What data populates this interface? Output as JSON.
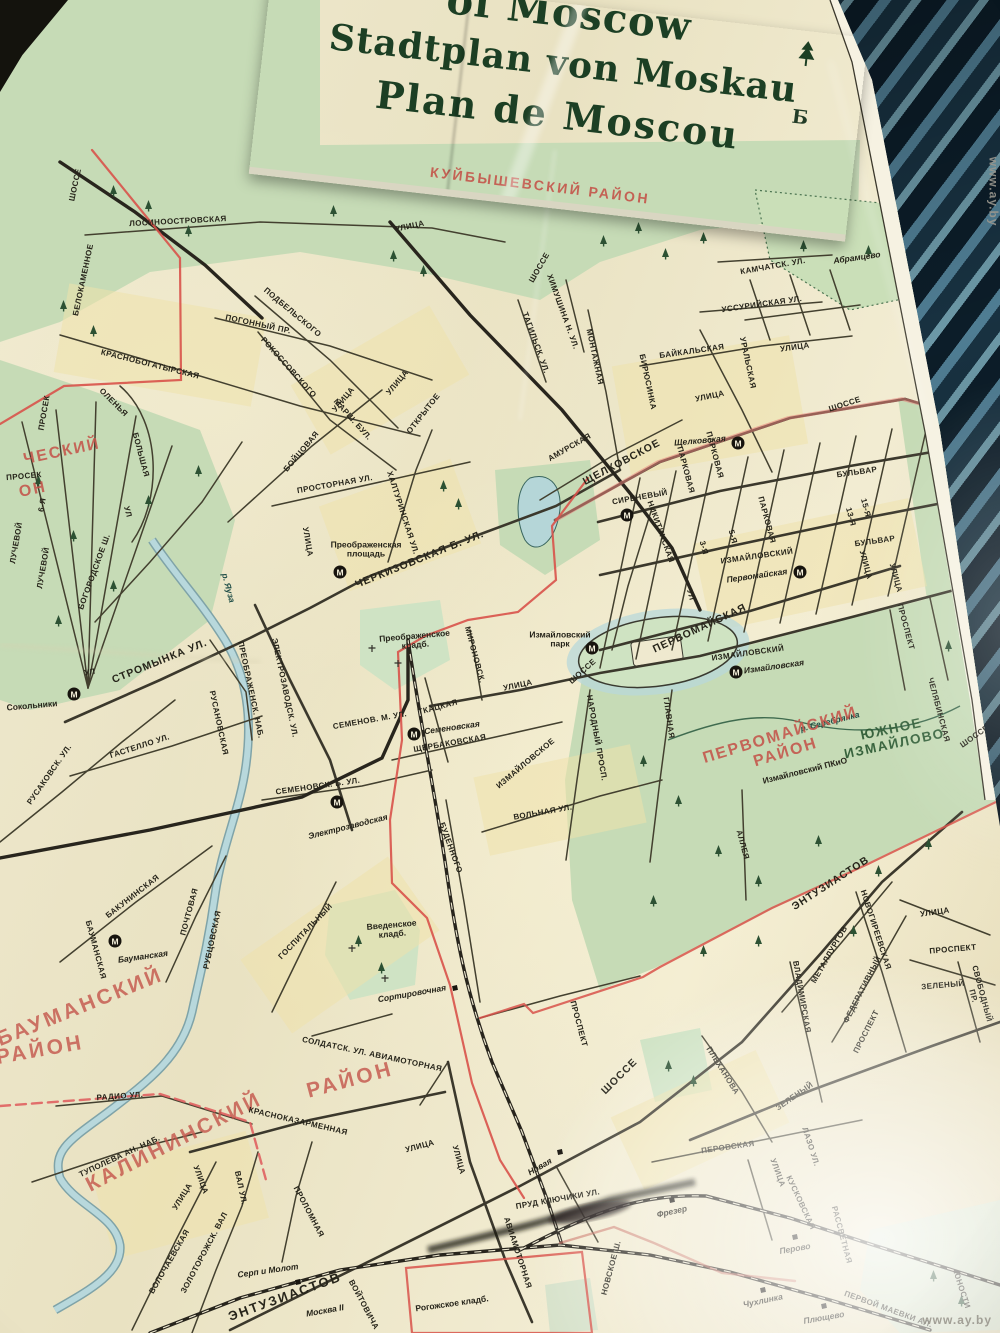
{
  "header": {
    "title_line1": "of Moscow",
    "title_line2": "Stadtplan von Moskau",
    "title_line3": "Plan de Moscou"
  },
  "photo": {
    "watermark": "www.ay.by"
  },
  "colors": {
    "paper": "#ece6c9",
    "park": "#c6dbb6",
    "water": "#aed2d8",
    "road_ink": "#3b382c",
    "rail_ink": "#28251d",
    "boundary_red": "#d8524a",
    "district_red": "#c4544a",
    "cover_green": "#8cad8a",
    "title_ink": "#1c3f24"
  },
  "metro_symbol": "М",
  "metro": [
    {
      "x": 74,
      "y": 694
    },
    {
      "x": 340,
      "y": 572
    },
    {
      "x": 627,
      "y": 515
    },
    {
      "x": 738,
      "y": 443
    },
    {
      "x": 800,
      "y": 572
    },
    {
      "x": 592,
      "y": 648
    },
    {
      "x": 736,
      "y": 672
    },
    {
      "x": 414,
      "y": 734
    },
    {
      "x": 337,
      "y": 802
    },
    {
      "x": 115,
      "y": 941
    }
  ],
  "rail_markers": [
    {
      "x": 455,
      "y": 988
    },
    {
      "x": 298,
      "y": 1282
    },
    {
      "x": 560,
      "y": 1152
    },
    {
      "x": 672,
      "y": 1200
    },
    {
      "x": 795,
      "y": 1237
    },
    {
      "x": 763,
      "y": 1290
    },
    {
      "x": 824,
      "y": 1306
    }
  ],
  "map_labels": [
    {
      "t": "КУЙБЫШЕВСКИЙ  РАЙОН",
      "x": 540,
      "y": 186,
      "r": 7,
      "c": 5
    },
    {
      "t": "ЛОСИНООСТРОВСКАЯ",
      "x": 178,
      "y": 222,
      "r": -3,
      "c": 0
    },
    {
      "t": "УЛИЦА",
      "x": 410,
      "y": 227,
      "r": -12,
      "c": 0
    },
    {
      "t": "ШОССЕ",
      "x": 540,
      "y": 268,
      "r": -60,
      "c": 0
    },
    {
      "t": "ШОССЕ",
      "x": 76,
      "y": 185,
      "r": -78,
      "c": 0
    },
    {
      "t": "БЕЛОКАМЕННОЕ",
      "x": 84,
      "y": 280,
      "r": -78,
      "c": 0
    },
    {
      "t": "ПОГОННЫЙ  ПР.",
      "x": 258,
      "y": 325,
      "r": 12,
      "c": 0
    },
    {
      "t": "ПОДБЕЛЬСКОГО",
      "x": 292,
      "y": 313,
      "r": 40,
      "c": 0
    },
    {
      "t": "РОКОССОВСКОГО",
      "x": 288,
      "y": 368,
      "r": 48,
      "c": 0
    },
    {
      "t": "МАРШ. БУЛ.",
      "x": 352,
      "y": 420,
      "r": 48,
      "c": 0
    },
    {
      "t": "БОЙЦОВАЯ",
      "x": 302,
      "y": 452,
      "r": -50,
      "c": 0
    },
    {
      "t": "УЛИЦА",
      "x": 344,
      "y": 400,
      "r": -50,
      "c": 0
    },
    {
      "t": "УЛИЦА",
      "x": 398,
      "y": 383,
      "r": -50,
      "c": 0
    },
    {
      "t": "ОТКРЫТОЕ",
      "x": 424,
      "y": 414,
      "r": -52,
      "c": 0
    },
    {
      "t": "КРАСНОБОГАТЫРСКАЯ",
      "x": 150,
      "y": 365,
      "r": 14,
      "c": 0
    },
    {
      "t": "ТАГИЛЬСК. УЛ.",
      "x": 535,
      "y": 343,
      "r": 70,
      "c": 0
    },
    {
      "t": "ХИМУШИНА Н. УЛ.",
      "x": 562,
      "y": 312,
      "r": 70,
      "c": 0
    },
    {
      "t": "МОНТАЖНАЯ",
      "x": 594,
      "y": 357,
      "r": 78,
      "c": 0
    },
    {
      "t": "БИРЮСИНКА",
      "x": 647,
      "y": 382,
      "r": 78,
      "c": 0
    },
    {
      "t": "КАМЧАТСК. УЛ.",
      "x": 773,
      "y": 267,
      "r": -10,
      "c": 0
    },
    {
      "t": "УССУРИЙСКАЯ УЛ.",
      "x": 762,
      "y": 305,
      "r": -8,
      "c": 0
    },
    {
      "t": "Абрамцево",
      "x": 857,
      "y": 258,
      "r": -8,
      "c": 3
    },
    {
      "t": "БАЙКАЛЬСКАЯ",
      "x": 692,
      "y": 352,
      "r": -8,
      "c": 0
    },
    {
      "t": "УРАЛЬСКАЯ",
      "x": 747,
      "y": 363,
      "r": 78,
      "c": 0
    },
    {
      "t": "УЛИЦА",
      "x": 795,
      "y": 348,
      "r": -8,
      "c": 0
    },
    {
      "t": "УЛИЦА",
      "x": 710,
      "y": 397,
      "r": -12,
      "c": 0
    },
    {
      "t": "ШОССЕ",
      "x": 845,
      "y": 405,
      "r": -18,
      "c": 0
    },
    {
      "t": "АМУРСКАЯ",
      "x": 570,
      "y": 448,
      "r": -30,
      "c": 0
    },
    {
      "t": "ЩЕЛКОВСКОЕ",
      "x": 622,
      "y": 463,
      "r": -28,
      "c": 1
    },
    {
      "t": "Щелковская",
      "x": 700,
      "y": 441,
      "r": -5,
      "c": 3
    },
    {
      "t": "СИРЕНЕВЫЙ",
      "x": 640,
      "y": 498,
      "r": -10,
      "c": 0
    },
    {
      "t": "НИКИТИНСКАЯ",
      "x": 660,
      "y": 532,
      "r": 70,
      "c": 0
    },
    {
      "t": "ПАРКОВАЯ",
      "x": 685,
      "y": 470,
      "r": 75,
      "c": 0
    },
    {
      "t": "ПАРКОВАЯ",
      "x": 714,
      "y": 455,
      "r": 75,
      "c": 0
    },
    {
      "t": "ПАРКОВАЯ",
      "x": 766,
      "y": 520,
      "r": 75,
      "c": 0
    },
    {
      "t": "БУЛЬВАР",
      "x": 857,
      "y": 473,
      "r": -8,
      "c": 0
    },
    {
      "t": "ИЗМАЙЛОВСКИЙ",
      "x": 757,
      "y": 557,
      "r": -8,
      "c": 0
    },
    {
      "t": "БУЛЬВАР",
      "x": 875,
      "y": 542,
      "r": -8,
      "c": 0
    },
    {
      "t": "3-Я",
      "x": 703,
      "y": 548,
      "r": 75,
      "c": 0
    },
    {
      "t": "5-Я",
      "x": 732,
      "y": 537,
      "r": 75,
      "c": 0
    },
    {
      "t": "13-Я",
      "x": 850,
      "y": 517,
      "r": 75,
      "c": 0
    },
    {
      "t": "15-Я",
      "x": 865,
      "y": 508,
      "r": 75,
      "c": 0
    },
    {
      "t": "УЛ",
      "x": 690,
      "y": 595,
      "r": 75,
      "c": 0
    },
    {
      "t": "УЛИЦА",
      "x": 865,
      "y": 565,
      "r": 75,
      "c": 0
    },
    {
      "t": "УЛИЦА",
      "x": 895,
      "y": 578,
      "r": 75,
      "c": 0
    },
    {
      "t": "Первомайская",
      "x": 757,
      "y": 576,
      "r": -8,
      "c": 3
    },
    {
      "t": "ПЕРВОМАЙСКАЯ",
      "x": 700,
      "y": 629,
      "r": -25,
      "c": 1
    },
    {
      "t": "ИЗМАЙЛОВСКИЙ",
      "x": 748,
      "y": 654,
      "r": -8,
      "c": 0
    },
    {
      "t": "ПРОСПЕКТ",
      "x": 905,
      "y": 627,
      "r": 75,
      "c": 0
    },
    {
      "t": "Измайловская",
      "x": 774,
      "y": 667,
      "r": -8,
      "c": 3
    },
    {
      "t": "МОСКОВСКАЯ",
      "x": 965,
      "y": 557,
      "r": 82,
      "c": 0
    },
    {
      "t": "В",
      "x": 962,
      "y": 503,
      "r": 0,
      "c": 8
    },
    {
      "t": "Б",
      "x": 800,
      "y": 118,
      "r": 7,
      "c": 8
    },
    {
      "t": "ЧЕРКИЗОВСКАЯ  Б.  УЛ.",
      "x": 420,
      "y": 560,
      "r": -22,
      "c": 1
    },
    {
      "t": "Преображенская\nплощадь",
      "x": 366,
      "y": 550,
      "r": 0,
      "c": 4
    },
    {
      "t": "ПРОСТОРНАЯ УЛ.",
      "x": 335,
      "y": 485,
      "r": -10,
      "c": 0
    },
    {
      "t": "ХАЛТУРИНСКАЯ УЛ.",
      "x": 402,
      "y": 513,
      "r": 72,
      "c": 0
    },
    {
      "t": "УЛИЦА",
      "x": 307,
      "y": 542,
      "r": 80,
      "c": 0
    },
    {
      "t": "Преображенское\nкладб.",
      "x": 415,
      "y": 641,
      "r": -5,
      "c": 4
    },
    {
      "t": "МИРОНОВСК.",
      "x": 474,
      "y": 655,
      "r": 75,
      "c": 0
    },
    {
      "t": "УЛИЦА",
      "x": 518,
      "y": 686,
      "r": -12,
      "c": 0
    },
    {
      "t": "р. Яуза",
      "x": 228,
      "y": 588,
      "r": 75,
      "c": 7
    },
    {
      "t": "СТРОМЫНКА УЛ.",
      "x": 160,
      "y": 662,
      "r": -22,
      "c": 1
    },
    {
      "t": "УЛ",
      "x": 90,
      "y": 673,
      "r": -10,
      "c": 0
    },
    {
      "t": "Сокольники",
      "x": 32,
      "y": 706,
      "r": -5,
      "c": 4
    },
    {
      "t": "ГАСТЕЛЛО УЛ.",
      "x": 140,
      "y": 747,
      "r": -18,
      "c": 0
    },
    {
      "t": "РУСАКОВСК. УЛ.",
      "x": 50,
      "y": 775,
      "r": -55,
      "c": 0
    },
    {
      "t": "РУСАНОВСКАЯ",
      "x": 218,
      "y": 723,
      "r": 78,
      "c": 0
    },
    {
      "t": "ПРЕОБРАЖЕНСК. НАБ.",
      "x": 250,
      "y": 690,
      "r": 78,
      "c": 0
    },
    {
      "t": "ЭЛЕКТРОЗАВОДСК. УЛ.",
      "x": 284,
      "y": 688,
      "r": 78,
      "c": 0
    },
    {
      "t": "БОГОРОДСКОЕ Ш.",
      "x": 95,
      "y": 572,
      "r": -70,
      "c": 0
    },
    {
      "t": "ОЛЕНЬЯ",
      "x": 113,
      "y": 403,
      "r": 45,
      "c": 0
    },
    {
      "t": "БОЛЬШАЯ",
      "x": 140,
      "y": 455,
      "r": 75,
      "c": 0
    },
    {
      "t": "УЛ",
      "x": 127,
      "y": 512,
      "r": 75,
      "c": 0
    },
    {
      "t": "ПРОСЕК",
      "x": 45,
      "y": 413,
      "r": -80,
      "c": 0
    },
    {
      "t": "ПРОСЕК",
      "x": 24,
      "y": 477,
      "r": -5,
      "c": 0
    },
    {
      "t": "6-Я",
      "x": 43,
      "y": 505,
      "r": -80,
      "c": 0
    },
    {
      "t": "ЛУЧЕВОЙ",
      "x": 17,
      "y": 543,
      "r": -80,
      "c": 0
    },
    {
      "t": "ЛУЧЕВОЙ",
      "x": 44,
      "y": 568,
      "r": -80,
      "c": 0
    },
    {
      "t": "ЧЕСКИЙ",
      "x": 62,
      "y": 452,
      "r": -12,
      "c": 11
    },
    {
      "t": "ОН",
      "x": 33,
      "y": 490,
      "r": -12,
      "c": 11
    },
    {
      "t": "Измайловский\nпарк",
      "x": 560,
      "y": 640,
      "r": 0,
      "c": 4
    },
    {
      "t": "ШОССЕ",
      "x": 583,
      "y": 672,
      "r": -42,
      "c": 0
    },
    {
      "t": "ИЗМАЙЛОВСКОЕ",
      "x": 526,
      "y": 764,
      "r": -40,
      "c": 0
    },
    {
      "t": "НАРОДНЫЙ ПРОСП.",
      "x": 596,
      "y": 738,
      "r": 80,
      "c": 0
    },
    {
      "t": "ГЛАВНАЯ",
      "x": 668,
      "y": 718,
      "r": 82,
      "c": 0
    },
    {
      "t": "АЛЛЕЯ",
      "x": 742,
      "y": 845,
      "r": 75,
      "c": 0
    },
    {
      "t": "р. Серебрянка",
      "x": 830,
      "y": 722,
      "r": -14,
      "c": 7
    },
    {
      "t": "ПЕРВОМАЙСКИЙ  РАЙОН",
      "x": 783,
      "y": 744,
      "r": -17,
      "c": 11
    },
    {
      "t": "ЮЖНОЕ\nИЗМАЙЛОВО",
      "x": 893,
      "y": 737,
      "r": -12,
      "c": 6
    },
    {
      "t": "Измайловский ПКиО",
      "x": 805,
      "y": 771,
      "r": -14,
      "c": 4
    },
    {
      "t": "ЧЕЛЯБИНСКАЯ",
      "x": 938,
      "y": 710,
      "r": 75,
      "c": 0
    },
    {
      "t": "ШОССЕ",
      "x": 975,
      "y": 737,
      "r": -35,
      "c": 0
    },
    {
      "t": "ТКАЦКАЯ",
      "x": 438,
      "y": 708,
      "r": -15,
      "c": 0
    },
    {
      "t": "Семеновская",
      "x": 452,
      "y": 728,
      "r": -8,
      "c": 3
    },
    {
      "t": "ЩЕРБАКОВСКАЯ",
      "x": 450,
      "y": 744,
      "r": -10,
      "c": 0
    },
    {
      "t": "СЕМЕНОВ. М. УЛ.",
      "x": 370,
      "y": 721,
      "r": -10,
      "c": 0
    },
    {
      "t": "СЕМЕНОВСК.  Б.  УЛ.",
      "x": 318,
      "y": 787,
      "r": -8,
      "c": 0
    },
    {
      "t": "Электрозаводская",
      "x": 348,
      "y": 827,
      "r": -14,
      "c": 3
    },
    {
      "t": "ВОЛЬНАЯ  УЛ.",
      "x": 543,
      "y": 813,
      "r": -10,
      "c": 0
    },
    {
      "t": "БУДЕННОГО",
      "x": 450,
      "y": 848,
      "r": 70,
      "c": 0
    },
    {
      "t": "ГОСПИТАЛЬНЫЙ",
      "x": 306,
      "y": 932,
      "r": -46,
      "c": 0
    },
    {
      "t": "Введенское\nкладб.",
      "x": 392,
      "y": 930,
      "r": -5,
      "c": 4
    },
    {
      "t": "Сортировочная",
      "x": 412,
      "y": 994,
      "r": -10,
      "c": 3
    },
    {
      "t": "ПРОСПЕКТ",
      "x": 578,
      "y": 1024,
      "r": 75,
      "c": 0
    },
    {
      "t": "СОЛДАТСК. УЛ.  АВИАМОТОРНАЯ",
      "x": 372,
      "y": 1055,
      "r": 12,
      "c": 0
    },
    {
      "t": "БАКУНИНСКАЯ",
      "x": 133,
      "y": 897,
      "r": -38,
      "c": 0
    },
    {
      "t": "БАУМАНСКАЯ",
      "x": 95,
      "y": 950,
      "r": 75,
      "c": 0
    },
    {
      "t": "Бауманская",
      "x": 143,
      "y": 957,
      "r": -8,
      "c": 3
    },
    {
      "t": "ПОЧТОВАЯ",
      "x": 190,
      "y": 912,
      "r": -75,
      "c": 0
    },
    {
      "t": "РУБЦОВСКАЯ",
      "x": 213,
      "y": 940,
      "r": -78,
      "c": 0
    },
    {
      "t": "БАУМАНСКИЙ",
      "x": 80,
      "y": 1007,
      "r": -22,
      "c": 10
    },
    {
      "t": "РАЙОН",
      "x": 40,
      "y": 1050,
      "r": -10,
      "c": 10
    },
    {
      "t": "КАЛИНИНСКИЙ",
      "x": 174,
      "y": 1142,
      "r": -27,
      "c": 10
    },
    {
      "t": "РАЙОН",
      "x": 350,
      "y": 1080,
      "r": -15,
      "c": 10
    },
    {
      "t": "РАДИО  УЛ.",
      "x": 120,
      "y": 1097,
      "r": -4,
      "c": 0
    },
    {
      "t": "ТУПОЛЕВА  АН.  НАБ.",
      "x": 120,
      "y": 1157,
      "r": -25,
      "c": 0
    },
    {
      "t": "КРАСНОКАЗАРМЕННАЯ",
      "x": 298,
      "y": 1122,
      "r": 13,
      "c": 0
    },
    {
      "t": "УЛИЦА",
      "x": 420,
      "y": 1147,
      "r": -15,
      "c": 0
    },
    {
      "t": "УЛИЦА",
      "x": 200,
      "y": 1180,
      "r": 70,
      "c": 0
    },
    {
      "t": "ВАЛ УЛ.",
      "x": 240,
      "y": 1188,
      "r": 78,
      "c": 0
    },
    {
      "t": "ПРОЛОМНАЯ",
      "x": 308,
      "y": 1212,
      "r": 62,
      "c": 0
    },
    {
      "t": "УЛИЦА",
      "x": 458,
      "y": 1160,
      "r": 75,
      "c": 0
    },
    {
      "t": "АВИАМОТОРНАЯ",
      "x": 517,
      "y": 1253,
      "r": 72,
      "c": 0
    },
    {
      "t": "Новая",
      "x": 540,
      "y": 1167,
      "r": -30,
      "c": 3
    },
    {
      "t": "ПРУД КЛЮЧИКИ УЛ.",
      "x": 558,
      "y": 1200,
      "r": -10,
      "c": 0
    },
    {
      "t": "ШОССЕ",
      "x": 620,
      "y": 1077,
      "r": -45,
      "c": 1
    },
    {
      "t": "ПЛЕХАНОВА",
      "x": 722,
      "y": 1071,
      "r": 58,
      "c": 0
    },
    {
      "t": "ЗЕЛЕНЫЙ",
      "x": 795,
      "y": 1097,
      "r": -35,
      "c": 0
    },
    {
      "t": "ПЕРОВСКАЯ",
      "x": 728,
      "y": 1148,
      "r": -8,
      "c": 0
    },
    {
      "t": "УЛИЦА",
      "x": 777,
      "y": 1173,
      "r": 70,
      "c": 0
    },
    {
      "t": "ЛАЗО УЛ.",
      "x": 810,
      "y": 1147,
      "r": 72,
      "c": 0
    },
    {
      "t": "ЭНТУЗИАСТОВ",
      "x": 831,
      "y": 884,
      "r": -33,
      "c": 1
    },
    {
      "t": "МЕТАЛЛУРГОВ",
      "x": 830,
      "y": 955,
      "r": -60,
      "c": 0
    },
    {
      "t": "НОВОГИРЕЕВСКАЯ",
      "x": 875,
      "y": 930,
      "r": 72,
      "c": 0
    },
    {
      "t": "ВЛАДИМИРСКАЯ",
      "x": 801,
      "y": 997,
      "r": 80,
      "c": 0
    },
    {
      "t": "ФЕДЕРАТИВНЫЙ",
      "x": 863,
      "y": 990,
      "r": -63,
      "c": 0
    },
    {
      "t": "ПРОСПЕКТ",
      "x": 867,
      "y": 1032,
      "r": -63,
      "c": 0
    },
    {
      "t": "УЛИЦА",
      "x": 935,
      "y": 913,
      "r": -8,
      "c": 0
    },
    {
      "t": "ПРОСПЕКТ",
      "x": 953,
      "y": 950,
      "r": -5,
      "c": 0
    },
    {
      "t": "ЗЕЛЕНЫЙ",
      "x": 943,
      "y": 986,
      "r": -5,
      "c": 0
    },
    {
      "t": "СВОБОДНЫЙ ПР.",
      "x": 977,
      "y": 995,
      "r": 75,
      "c": 0
    },
    {
      "t": "ЭНТУЗИАСТОВ",
      "x": 285,
      "y": 1297,
      "r": -20,
      "c": 2
    },
    {
      "t": "Серп и Молот",
      "x": 268,
      "y": 1271,
      "r": -8,
      "c": 3
    },
    {
      "t": "Москва II",
      "x": 325,
      "y": 1311,
      "r": -10,
      "c": 3
    },
    {
      "t": "ВОЙТОВИЧА",
      "x": 363,
      "y": 1305,
      "r": 62,
      "c": 0
    },
    {
      "t": "ЗОЛОТОРОЖСК. ВАЛ",
      "x": 205,
      "y": 1253,
      "r": -62,
      "c": 0
    },
    {
      "t": "УЛИЦА",
      "x": 183,
      "y": 1197,
      "r": -58,
      "c": 0
    },
    {
      "t": "ВОЛОЧАЕВСКАЯ",
      "x": 170,
      "y": 1262,
      "r": -60,
      "c": 0
    },
    {
      "t": "Рогожское кладб.",
      "x": 452,
      "y": 1304,
      "r": -8,
      "c": 4
    },
    {
      "t": "Фрезер",
      "x": 672,
      "y": 1212,
      "r": -12,
      "c": 3
    },
    {
      "t": "Перово",
      "x": 795,
      "y": 1249,
      "r": -10,
      "c": 3
    },
    {
      "t": "Чухлинка",
      "x": 763,
      "y": 1301,
      "r": -12,
      "c": 3
    },
    {
      "t": "Плющево",
      "x": 824,
      "y": 1318,
      "r": -10,
      "c": 3
    },
    {
      "t": "КУСКОВСКАЯ",
      "x": 800,
      "y": 1203,
      "r": 65,
      "c": 0
    },
    {
      "t": "РАССВЕТНАЯ",
      "x": 841,
      "y": 1235,
      "r": 75,
      "c": 0
    },
    {
      "t": "ПЕРВОЙ МАЕВКИ АЛ.",
      "x": 888,
      "y": 1310,
      "r": 20,
      "c": 0
    },
    {
      "t": "ЮНОСТИ",
      "x": 961,
      "y": 1290,
      "r": 72,
      "c": 0
    },
    {
      "t": "НОВСКОЕ Ш.",
      "x": 612,
      "y": 1268,
      "r": -75,
      "c": 0
    }
  ]
}
